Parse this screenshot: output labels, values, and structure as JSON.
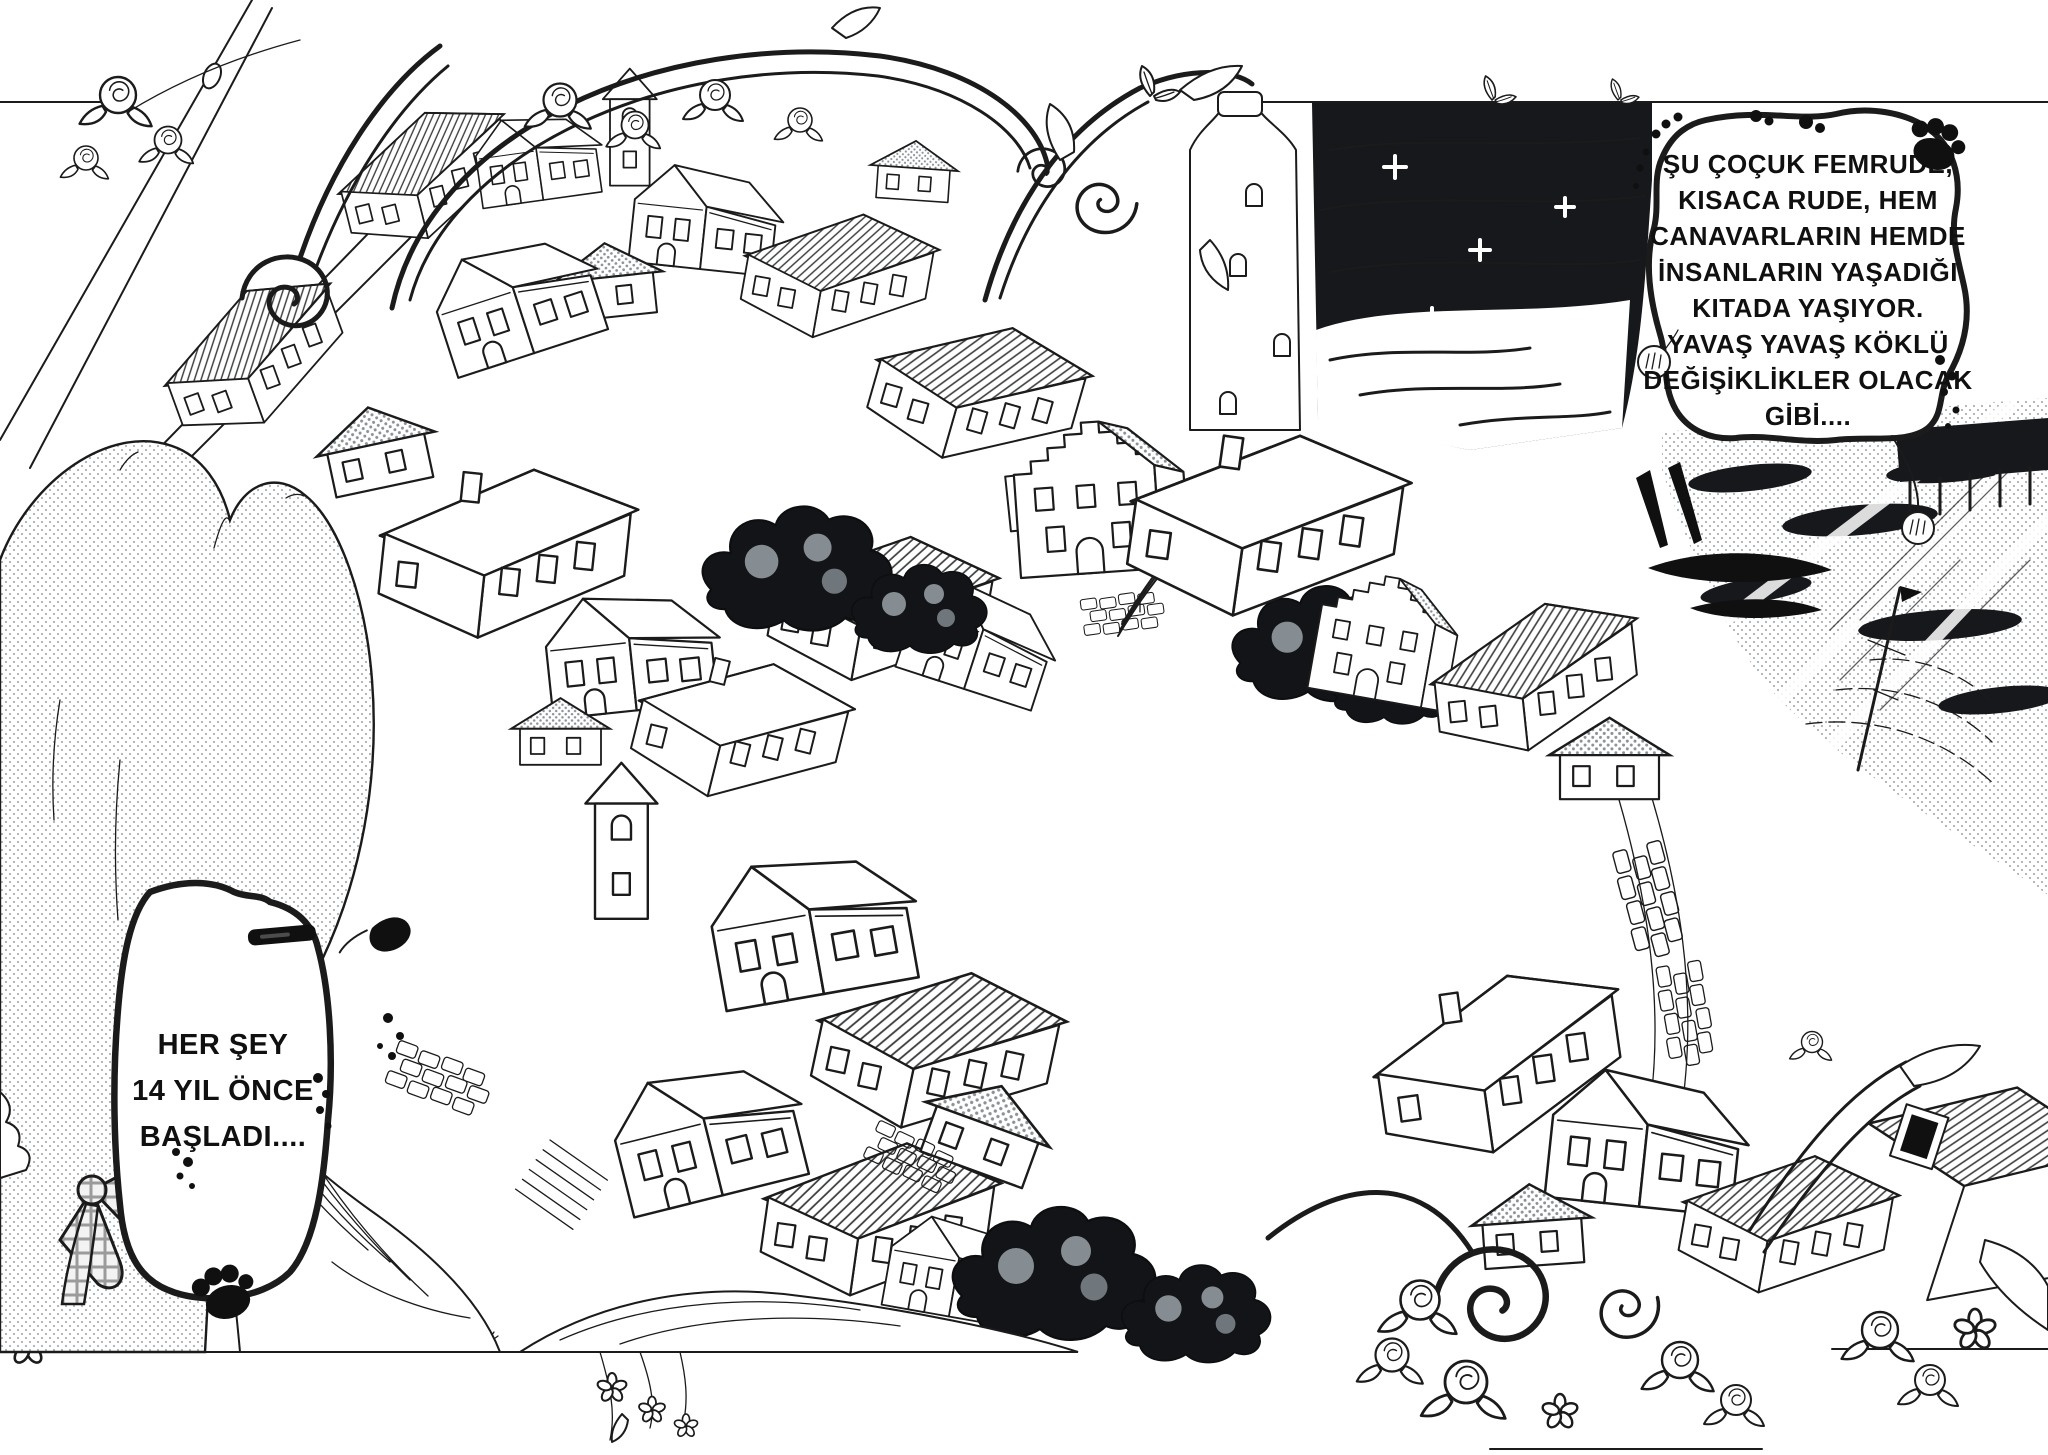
{
  "page": {
    "type": "manga double-page spread",
    "language": "Turkish",
    "art_style": "black-and-white ink line art with halftone screentone"
  },
  "colors": {
    "ink": "#1b1b1b",
    "paper": "#ffffff",
    "halftone_dot": "#a9b0b6",
    "sea_dark": "#16181b"
  },
  "speech_bubble": {
    "position": "top-right",
    "border": "hand-drawn wavy outline decorated with paw prints",
    "lines": [
      "ŞU ÇOÇUK FEMRUDE,",
      "KISACA RUDE, HEM",
      "CANAVARLARIN HEMDE",
      "İNSANLARIN YAŞADIĞI",
      "KITADA YAŞIYOR.",
      "YAVAŞ YAVAŞ KÖKLÜ",
      "DEĞİŞİKLİKLER OLACAK",
      "GİBİ...."
    ],
    "text": "ŞU ÇOÇUK FEMRUDE, KISACA RUDE, HEM CANAVARLARIN HEMDE İNSANLARIN YAŞADIĞI KITADA YAŞIYOR. YAVAŞ YAVAŞ KÖKLÜ DEĞİŞİKLİKLER OLACAK GİBİ...."
  },
  "caption_box": {
    "position": "bottom-left",
    "border": "hand-drawn wavy box with black clips and a paw print",
    "lines": [
      "HER ŞEY",
      "14 YIL ÖNCE",
      "BAŞLADI...."
    ],
    "text": "HER ŞEY 14 YIL ÖNCE BAŞLADI...."
  },
  "scene": {
    "elements": [
      "hillside old town of gabled stone houses",
      "harbor with dark hatched sea and sparkles",
      "boats and mast at the quay",
      "tall white tower by the water",
      "cat-eared character seen from behind in foreground",
      "plaid bow ribbon on character",
      "ornate rose and scroll flourishes framing the page",
      "snail on the bottom panel border"
    ],
    "icon_names": [
      "paw-print-icon",
      "paw-pad-charm-icon",
      "snail-icon",
      "rose-icon",
      "swirl-ornament-icon",
      "leaf-sprig-icon",
      "sparkle-icon",
      "boat-icon"
    ]
  }
}
